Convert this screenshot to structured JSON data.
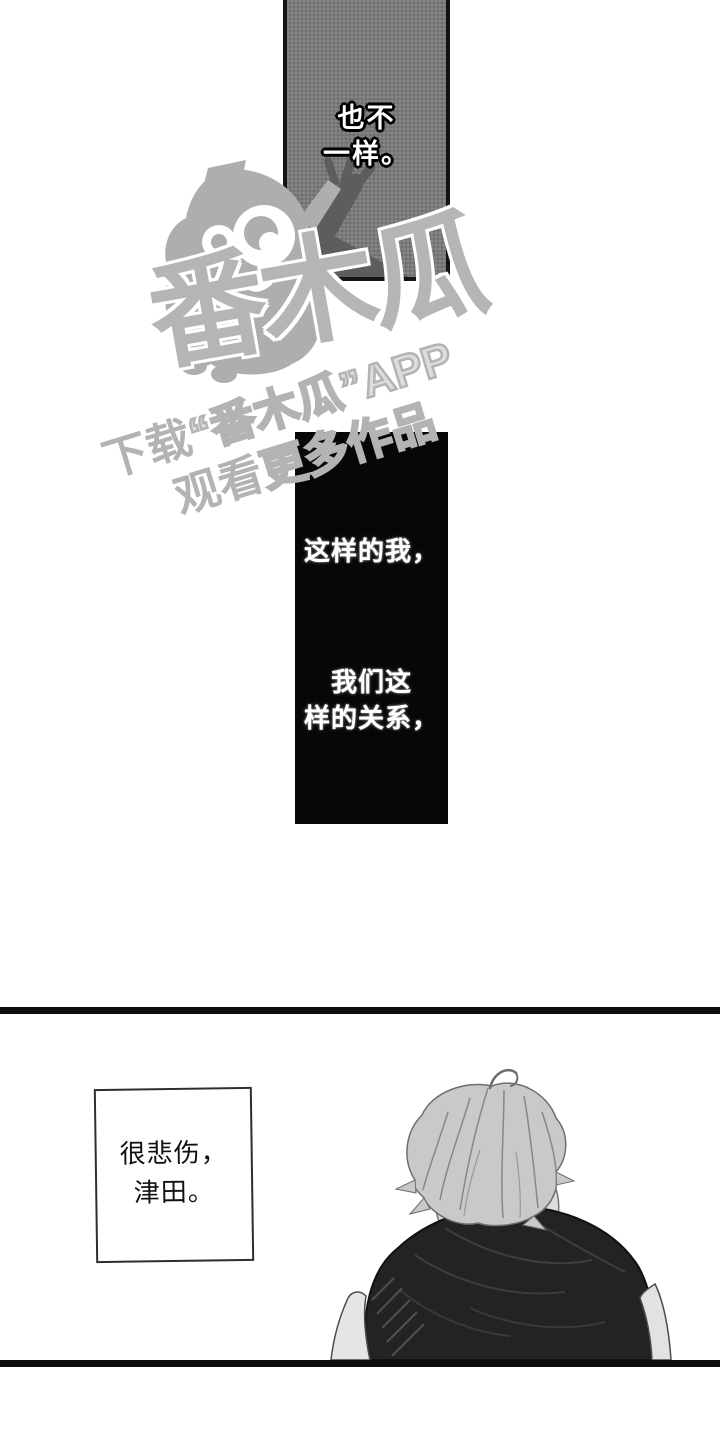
{
  "panels": {
    "top": {
      "caption_lines": [
        "也不",
        "一样。"
      ]
    },
    "middle": {
      "caption1": "这样的我，",
      "caption2_lines": [
        "我们这",
        "样的关系，"
      ]
    },
    "bottom": {
      "speech_lines": [
        "很悲伤，",
        "津田。"
      ]
    }
  },
  "watermark": {
    "brand": "番木瓜",
    "line1_solid": "下载",
    "line1_outline": "“番木瓜”APP",
    "line2_solid": "观看",
    "line2_outline": "更多作品",
    "mascot": "papaya-mascot"
  },
  "colors": {
    "panel_gray": "#7a7a7a",
    "panel_black": "#070707",
    "panel_border": "#141414",
    "watermark_gray": "#b3b3b3",
    "hair_gray": "#c9c9c9",
    "collar_gray": "#dcdcdc",
    "sweater_dark": "#232323",
    "arm_silhouette_gray": "#5d5d5d"
  }
}
